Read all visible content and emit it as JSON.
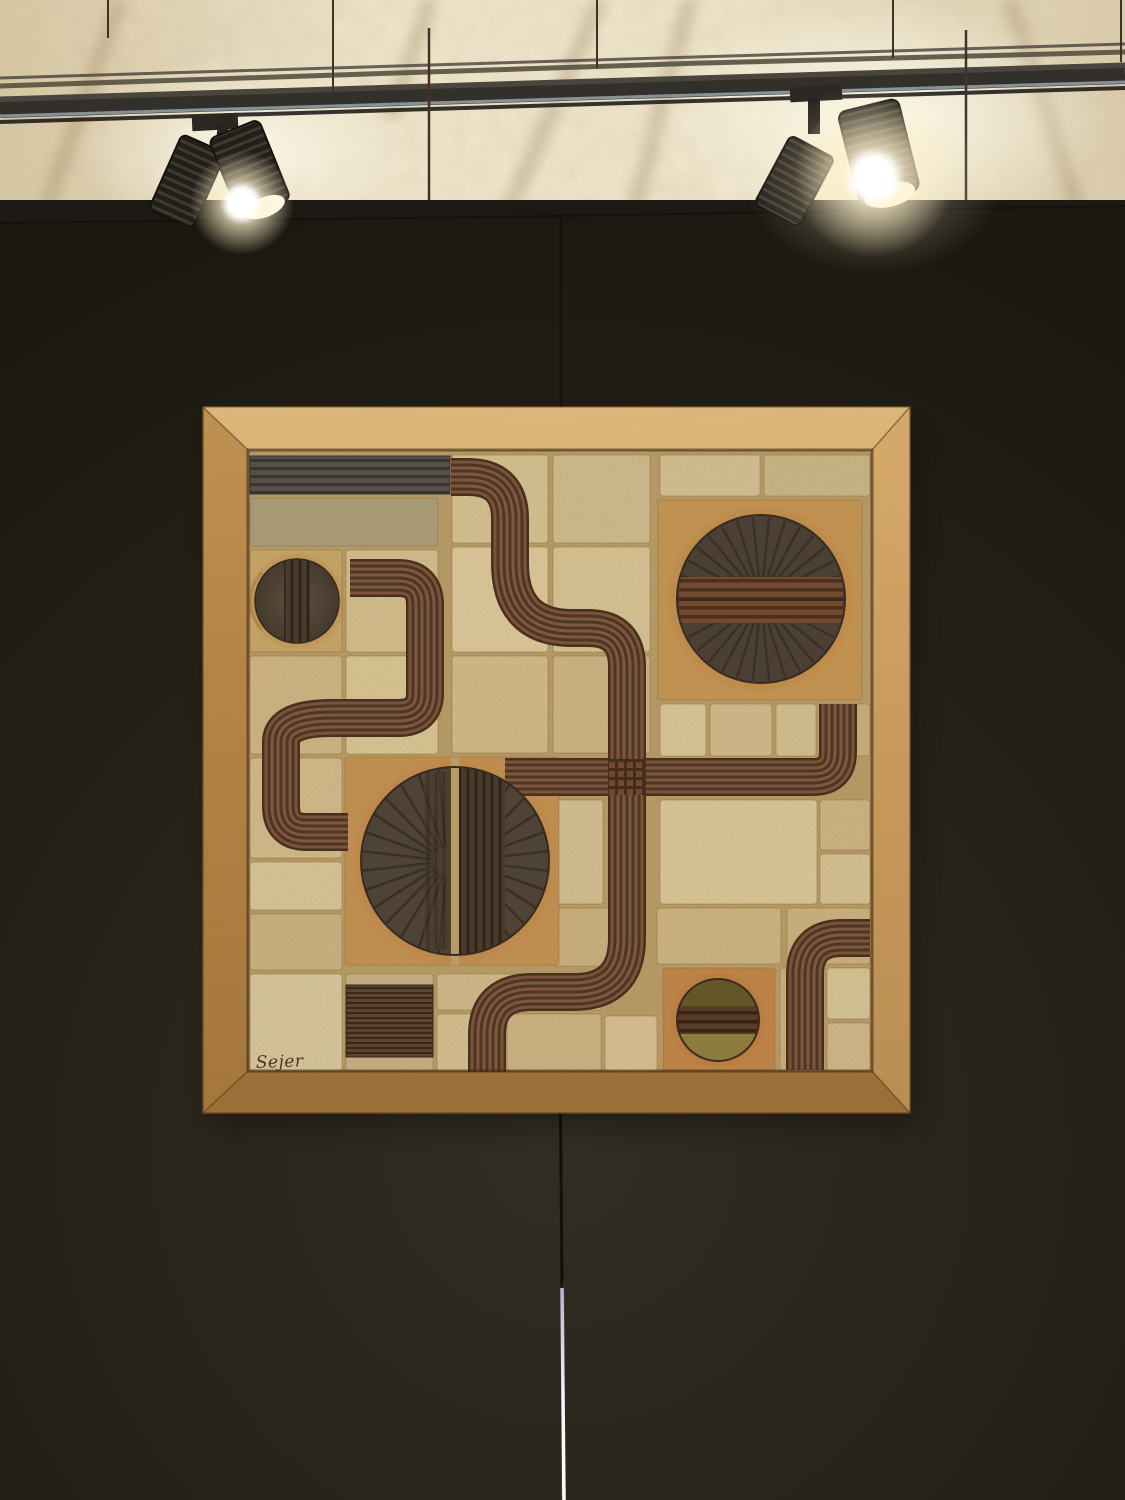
{
  "artwork": {
    "signature": "Sejer"
  },
  "scene": {
    "spotlights_left": 2,
    "spotlights_right": 2,
    "wall_panels": 2
  },
  "palette": {
    "ceiling": "#e6d9b8",
    "wall": "#2a2620",
    "wall_dark": "#1c1914",
    "frame_wood": "#c8944f",
    "grout": "#b79c66",
    "tile_beige": "#d2bd8d",
    "tile_sage": "#a89d79",
    "halo_rust": "#b06f2d",
    "relief_brown": "#7c5238",
    "relief_groove": "#4f3623",
    "relief_dark_circle": "#4c4034",
    "ridged_bar_gray": "#56504a",
    "olive_top": "#635627",
    "olive_bottom": "#8d7b3e",
    "glow": "#fff8e0",
    "seam_light": "#f2eef8"
  }
}
